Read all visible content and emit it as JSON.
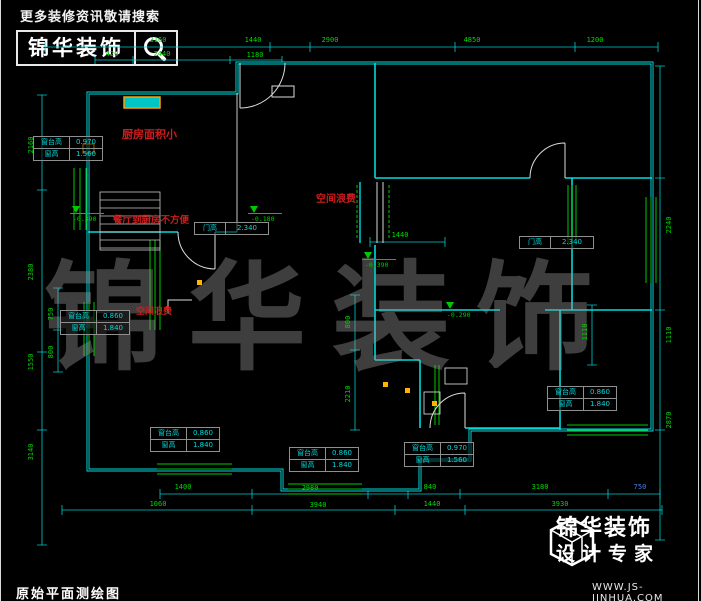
{
  "header": {
    "tagline": "更多装修资讯敬请搜索",
    "brand": "锦华装饰",
    "search_icon": "magnifier-icon"
  },
  "watermark": "锦华装饰",
  "drawing": {
    "title": "原始平面测绘图",
    "red_notes": [
      {
        "text": "厨房面积小",
        "x": 122,
        "y": 126,
        "size": 11
      },
      {
        "text": "餐厅到厨房不方便",
        "x": 113,
        "y": 212,
        "size": 9.5
      },
      {
        "text": "空间浪费",
        "x": 316,
        "y": 190,
        "size": 10
      },
      {
        "text": "空间浪费",
        "x": 136,
        "y": 304,
        "size": 9
      }
    ],
    "elevation_markers": [
      {
        "value": "-0.390",
        "x": 70,
        "y": 206
      },
      {
        "value": "-0.180",
        "x": 248,
        "y": 206
      },
      {
        "value": "-0.390",
        "x": 362,
        "y": 252
      },
      {
        "value": "-0.290",
        "x": 444,
        "y": 302
      }
    ],
    "window_tables": [
      {
        "x": 33,
        "y": 136,
        "rows": [
          [
            "窗台高",
            "0.970"
          ],
          [
            "窗高",
            "1.560"
          ]
        ]
      },
      {
        "x": 60,
        "y": 310,
        "rows": [
          [
            "窗台高",
            "0.860"
          ],
          [
            "窗高",
            "1.840"
          ]
        ]
      },
      {
        "x": 150,
        "y": 427,
        "rows": [
          [
            "窗台高",
            "0.860"
          ],
          [
            "窗高",
            "1.840"
          ]
        ]
      },
      {
        "x": 289,
        "y": 447,
        "rows": [
          [
            "窗台高",
            "0.860"
          ],
          [
            "窗高",
            "1.840"
          ]
        ]
      },
      {
        "x": 404,
        "y": 442,
        "rows": [
          [
            "窗台高",
            "0.970"
          ],
          [
            "窗高",
            "1.560"
          ]
        ]
      },
      {
        "x": 547,
        "y": 386,
        "rows": [
          [
            "窗台高",
            "0.860"
          ],
          [
            "窗高",
            "1.840"
          ]
        ]
      }
    ],
    "door_tags": [
      {
        "x": 194,
        "y": 222,
        "label": "门高",
        "value": "2.340"
      },
      {
        "x": 519,
        "y": 236,
        "label": "门高",
        "value": "2.340"
      }
    ],
    "dim_labels": [
      {
        "text": "3160",
        "x": 158,
        "y": 40
      },
      {
        "text": "1440",
        "x": 253,
        "y": 40
      },
      {
        "text": "2900",
        "x": 330,
        "y": 40
      },
      {
        "text": "4850",
        "x": 472,
        "y": 40
      },
      {
        "text": "1200",
        "x": 595,
        "y": 40
      },
      {
        "text": "420",
        "x": 112,
        "y": 54
      },
      {
        "text": "2440",
        "x": 162,
        "y": 54
      },
      {
        "text": "1180",
        "x": 255,
        "y": 55
      },
      {
        "text": "2160",
        "x": 31,
        "y": 145,
        "rot": -90
      },
      {
        "text": "2380",
        "x": 31,
        "y": 272,
        "rot": -90
      },
      {
        "text": "1550",
        "x": 31,
        "y": 362,
        "rot": -90
      },
      {
        "text": "750",
        "x": 51,
        "y": 314,
        "rot": -90
      },
      {
        "text": "800",
        "x": 51,
        "y": 352,
        "rot": -90
      },
      {
        "text": "3140",
        "x": 31,
        "y": 452,
        "rot": -90
      },
      {
        "text": "2240",
        "x": 669,
        "y": 225,
        "rot": -90
      },
      {
        "text": "1110",
        "x": 669,
        "y": 335,
        "rot": -90
      },
      {
        "text": "2870",
        "x": 669,
        "y": 420,
        "rot": -90
      },
      {
        "text": "800",
        "x": 348,
        "y": 322,
        "rot": -90
      },
      {
        "text": "2210",
        "x": 348,
        "y": 394,
        "rot": -90
      },
      {
        "text": "1110",
        "x": 585,
        "y": 332,
        "rot": -90
      },
      {
        "text": "1440",
        "x": 400,
        "y": 235
      },
      {
        "text": "1400",
        "x": 183,
        "y": 487
      },
      {
        "text": "2980",
        "x": 310,
        "y": 488
      },
      {
        "text": "840",
        "x": 430,
        "y": 487
      },
      {
        "text": "3180",
        "x": 540,
        "y": 487
      },
      {
        "text": "750",
        "x": 640,
        "y": 487,
        "color": "#4a7fe0"
      },
      {
        "text": "1060",
        "x": 158,
        "y": 504
      },
      {
        "text": "3940",
        "x": 318,
        "y": 505
      },
      {
        "text": "1440",
        "x": 432,
        "y": 504
      },
      {
        "text": "3930",
        "x": 560,
        "y": 504
      }
    ]
  },
  "footer": {
    "brand": "锦华装饰",
    "tagline": "设计专家",
    "website": "WWW.JS-JINHUA.COM",
    "logo_icon": "cube-logo-icon"
  },
  "colors": {
    "background": "#000000",
    "wall": "#00dcdc",
    "window": "#00c800",
    "dim_text": "#00d800",
    "annotation": "#cf1d1d",
    "highlight": "#ffb400",
    "door": "#dcdcdc",
    "blue_dim": "#4a7fe0"
  }
}
